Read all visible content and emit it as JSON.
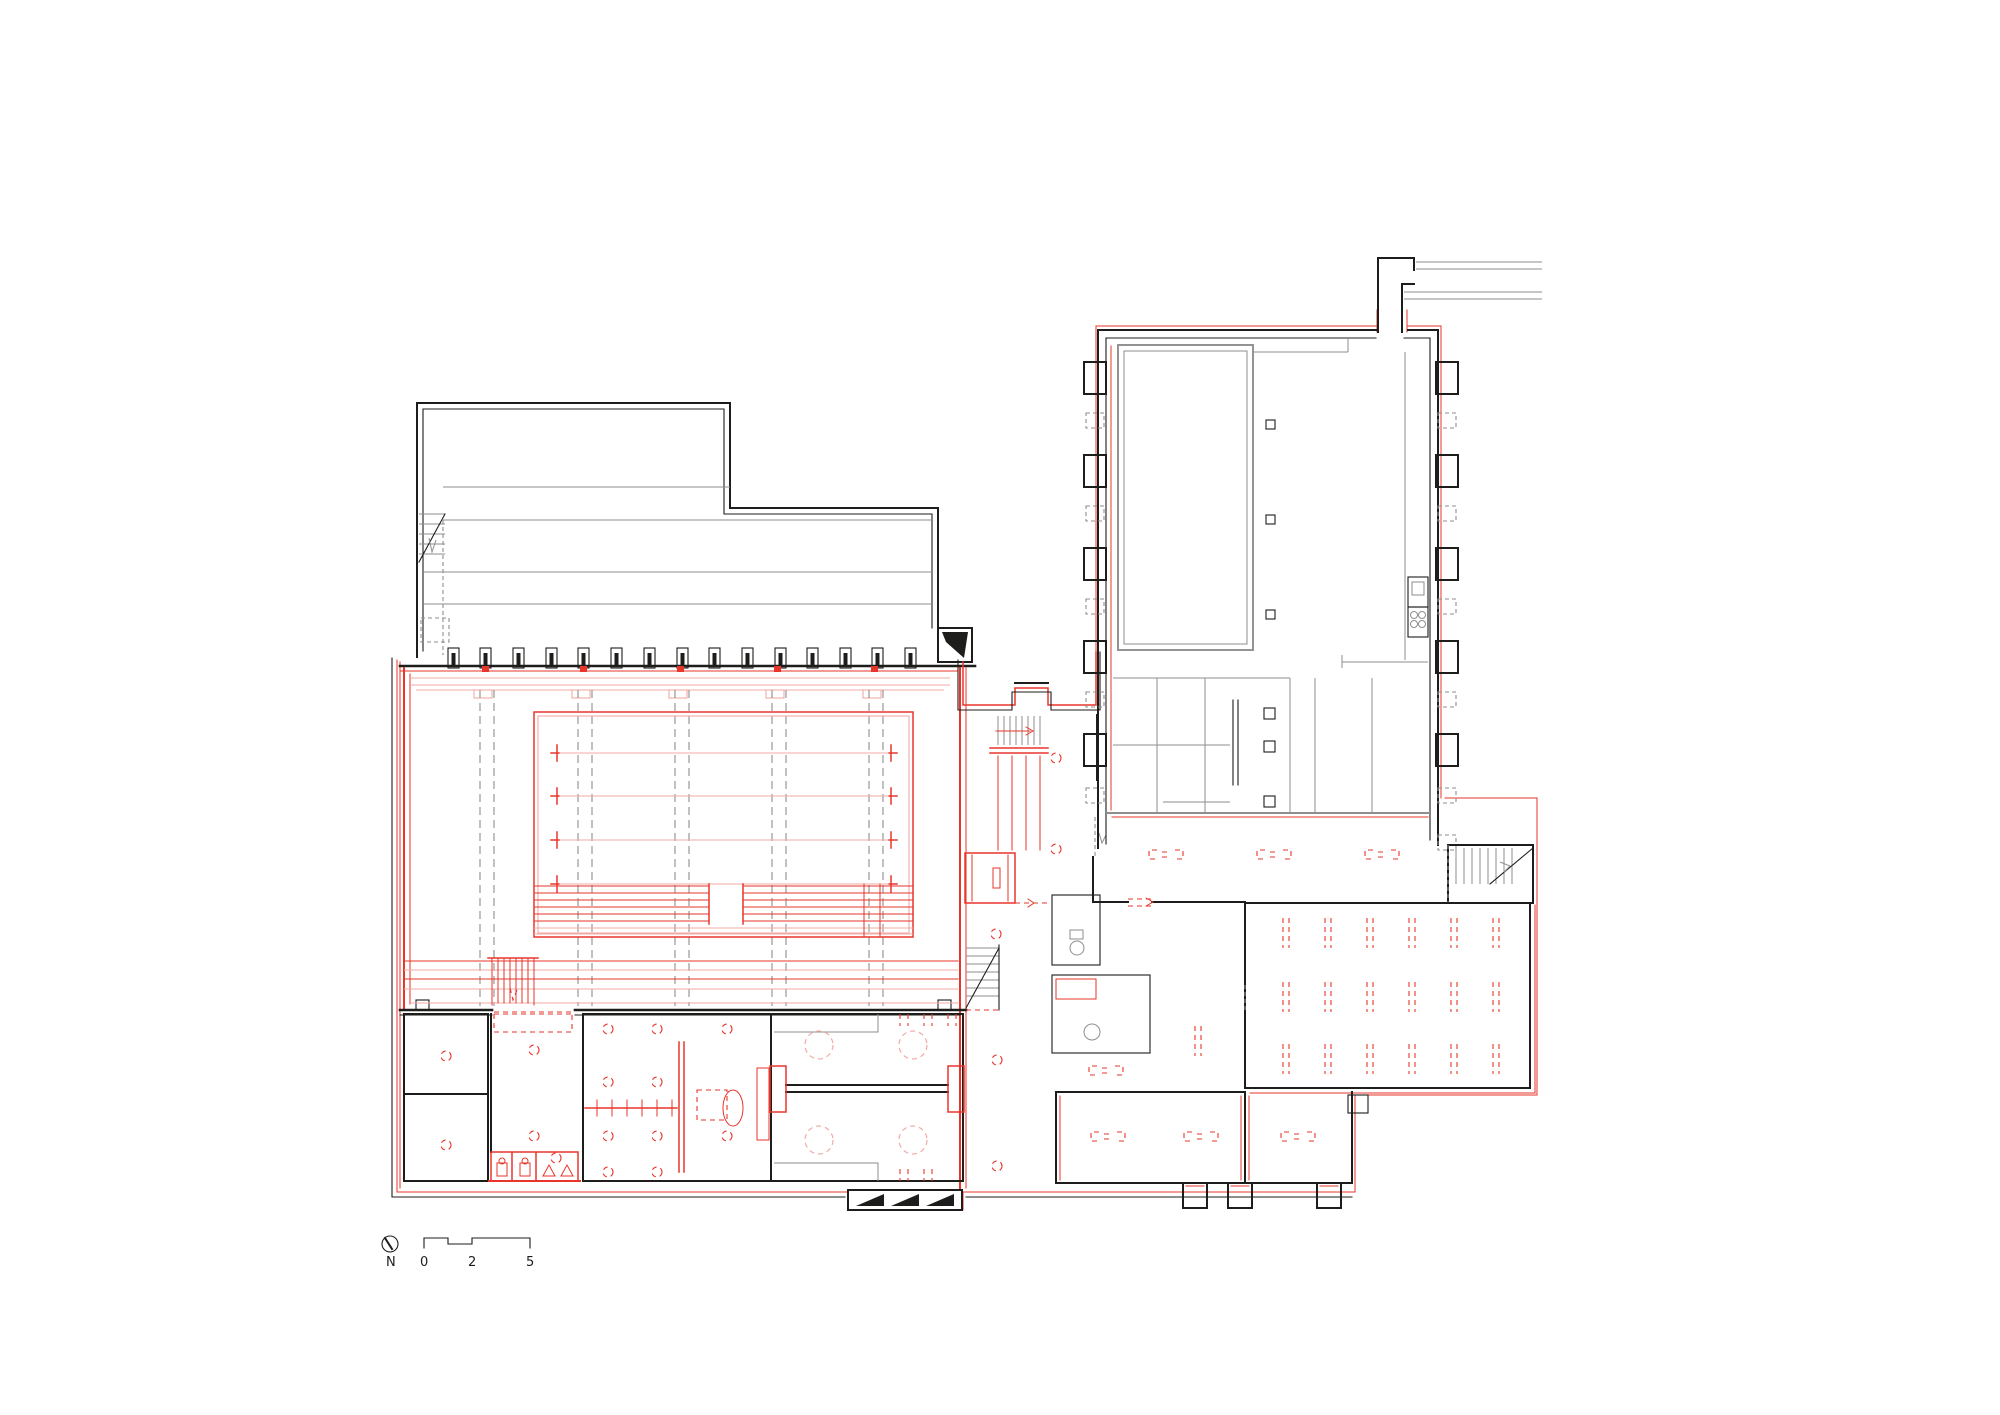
{
  "scale_bar": {
    "north_label": "N",
    "ticks": [
      "0",
      "2",
      "5"
    ]
  },
  "symbols": {
    "north_arrow": "compass-circle-with-needle",
    "column": "rect-with-solid-core",
    "pilaster_solid": "open-square-buttress",
    "pilaster_removed": "dashed-square",
    "vent_marker": "double-dashed-vertical-ticks",
    "floor_marker": "bracket-equals-bracket",
    "stair": "parallel-treads-with-arrow",
    "elevator": "red-shaft-with-door",
    "pool_lane": "line-with-t-ends",
    "wc": "toilet-fixture",
    "shower": "triangle-drain"
  },
  "colors": {
    "background": "#ffffff",
    "ink": "#1d1d1b",
    "gray": "#8e8e8c",
    "lgray": "#b7b7b5",
    "red": "#e8352b",
    "pale": "#f2aaa6"
  }
}
